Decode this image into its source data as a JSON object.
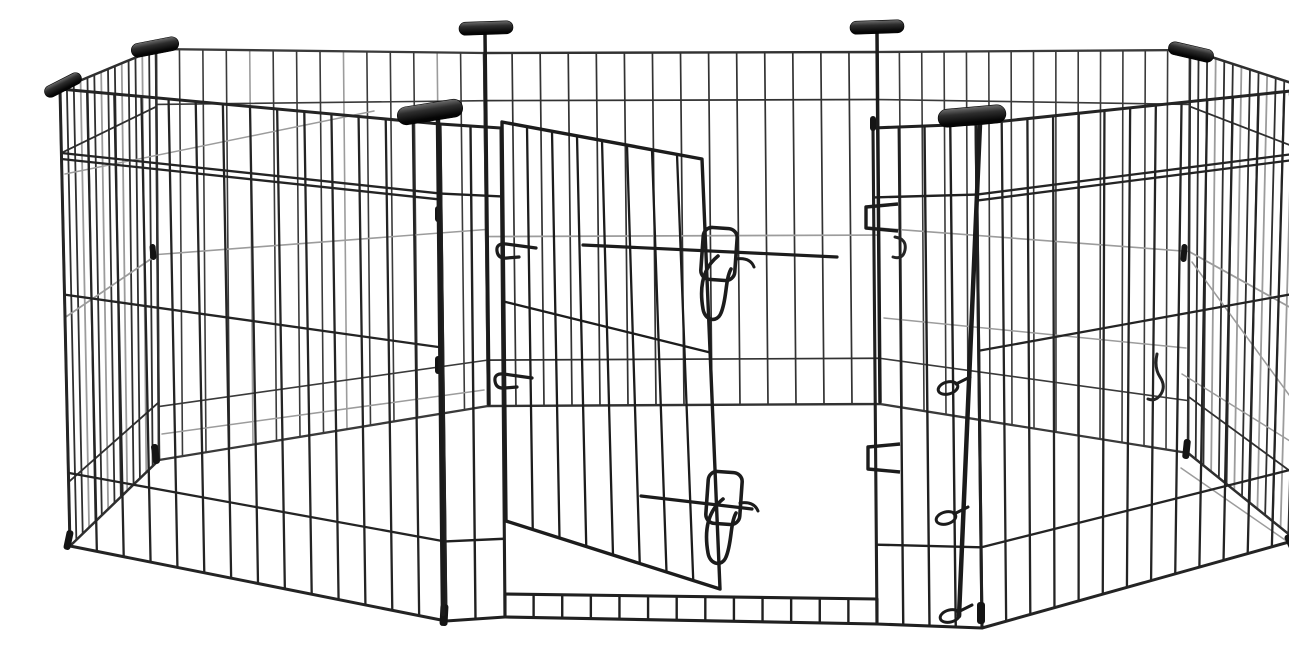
{
  "meta": {
    "type": "product-photo",
    "subject": "Black metal wire 8-panel foldable pet exercise playpen arranged as an octagon, with a walk-through gate standing ajar, two sliding wire latch clips, latch keeper brackets, black plastic corner caps, wire hinge pins and T-shaped carrying handles, photographed on a seamless white background",
    "background_color": "#ffffff",
    "wire_color_dark": "#242424",
    "wire_color_mid": "#383838",
    "wire_color_light": "#9c9c9c",
    "plastic_color": "#141414"
  },
  "pen": {
    "panels": [
      {
        "layer": "back",
        "name": "back-left",
        "tl": [
          116,
          33
        ],
        "tr": [
          444,
          37
        ],
        "br": [
          448,
          390
        ],
        "bl": [
          119,
          444
        ],
        "wires": 13,
        "stroke": "#3a3a3a",
        "width": 1.6,
        "light_every": 4,
        "rails": [
          {
            "t": 0.135
          },
          {
            "t": 0.5,
            "light": true
          },
          {
            "t": 0.87
          }
        ]
      },
      {
        "layer": "back",
        "name": "back-center",
        "tl": [
          444,
          37
        ],
        "tr": [
          837,
          36
        ],
        "br": [
          840,
          388
        ],
        "bl": [
          448,
          390
        ],
        "wires": 13,
        "stroke": "#323232",
        "width": 1.7,
        "rails": [
          {
            "t": 0.135
          },
          {
            "t": 0.52,
            "light": true
          },
          {
            "t": 0.87
          }
        ]
      },
      {
        "layer": "back",
        "name": "back-right",
        "tl": [
          837,
          36
        ],
        "tr": [
          1150,
          34
        ],
        "br": [
          1148,
          437
        ],
        "bl": [
          840,
          388
        ],
        "wires": 13,
        "stroke": "#3a3a3a",
        "width": 1.6,
        "rails": [
          {
            "t": 0.135
          },
          {
            "t": 0.5,
            "light": true
          },
          {
            "t": 0.87
          }
        ]
      },
      {
        "layer": "back",
        "name": "left-side",
        "tl": [
          20,
          73
        ],
        "tr": [
          116,
          33
        ],
        "br": [
          119,
          444
        ],
        "bl": [
          30,
          530
        ],
        "wires": 13,
        "stroke": "#2f2f2f",
        "width": 1.8,
        "light_every": 3,
        "rails": [
          {
            "t": 0.14
          },
          {
            "t": 0.5,
            "light": true
          },
          {
            "t": 0.86
          }
        ]
      },
      {
        "layer": "back",
        "name": "right-side",
        "tl": [
          1150,
          34
        ],
        "tr": [
          1270,
          73
        ],
        "br": [
          1256,
          524
        ],
        "bl": [
          1148,
          437
        ],
        "wires": 13,
        "stroke": "#2f2f2f",
        "width": 1.8,
        "light_every": 3,
        "rails": [
          {
            "t": 0.14
          },
          {
            "t": 0.5,
            "light": true
          },
          {
            "t": 0.86
          }
        ]
      },
      {
        "layer": "front",
        "name": "front-left",
        "tl": [
          20,
          73
        ],
        "tr": [
          400,
          108
        ],
        "br": [
          406,
          605
        ],
        "bl": [
          30,
          530
        ],
        "wires": 13,
        "stroke": "#242424",
        "width": 2.3,
        "rails": [
          {
            "t": 0.14,
            "d": true
          },
          {
            "t": 0.45
          },
          {
            "t": 0.84
          }
        ]
      },
      {
        "layer": "front",
        "name": "front-right",
        "tl": [
          936,
          108
        ],
        "tr": [
          1270,
          73
        ],
        "br": [
          1256,
          524
        ],
        "bl": [
          942,
          612
        ],
        "wires": 12,
        "stroke": "#242424",
        "width": 2.3,
        "rails": [
          {
            "t": 0.14,
            "d": true
          },
          {
            "t": 0.45
          },
          {
            "t": 0.84
          }
        ]
      },
      {
        "layer": "front",
        "name": "gate-left-section",
        "tl": [
          400,
          108
        ],
        "tr": [
          461,
          112
        ],
        "br": [
          465,
          601
        ],
        "bl": [
          406,
          605
        ],
        "wires": 1,
        "stroke": "#202020",
        "width": 2.4,
        "rails": [
          {
            "t": 0.14
          },
          {
            "t": 0.84
          }
        ]
      },
      {
        "layer": "front",
        "name": "gate-right-section",
        "tl": [
          833,
          112
        ],
        "tr": [
          936,
          108
        ],
        "br": [
          942,
          612
        ],
        "bl": [
          837,
          608
        ],
        "wires": 3,
        "stroke": "#202020",
        "width": 2.4,
        "rails": [
          {
            "t": 0.14
          },
          {
            "t": 0.84
          }
        ]
      },
      {
        "layer": "front",
        "name": "gate-threshold",
        "tl": [
          465,
          578
        ],
        "tr": [
          837,
          583
        ],
        "br": [
          837,
          608
        ],
        "bl": [
          465,
          601
        ],
        "wires": 12,
        "stroke": "#202020",
        "width": 2.4,
        "rails": []
      }
    ],
    "light_wires": [
      [
        25,
        158,
        334,
        95
      ],
      [
        122,
        418,
        444,
        374
      ],
      [
        1152,
        246,
        1263,
        398
      ],
      [
        1142,
        358,
        1258,
        430
      ],
      [
        1141,
        452,
        1248,
        526
      ],
      [
        844,
        302,
        1146,
        332
      ]
    ],
    "door": {
      "frame": {
        "tl": [
          462,
          106
        ],
        "tr": [
          662,
          143
        ],
        "br": [
          680,
          573
        ],
        "bl": [
          466,
          505
        ]
      },
      "wires": 7,
      "stroke": "#1c1c1c",
      "width": 2.6,
      "rails": [
        0.45
      ],
      "bars": [
        [
          543,
          229,
          797,
          241
        ],
        [
          601,
          480,
          712,
          493
        ]
      ],
      "latches": [
        {
          "loop": {
            "x": 662,
            "y": 212,
            "w": 34,
            "h": 52,
            "rx": 9,
            "rot": 4
          },
          "hook": "M678,240 C663,252 659,270 663,293 C665,305 677,307 681,297 C687,283 685,264 691,253",
          "snag": "M696,243 q14,-2 18,8"
        },
        {
          "loop": {
            "x": 667,
            "y": 456,
            "w": 34,
            "h": 52,
            "rx": 9,
            "rot": 4
          },
          "hook": "M683,483 C668,495 664,514 668,537 C670,549 682,551 686,541 C692,527 690,508 696,497",
          "snag": "M700,487 q14,-2 18,8"
        }
      ],
      "hinges": [
        "M496,232 L466,228 q-10,-1 -9,7 q1,8 10,7 l12,-1",
        "M492,362 L464,358 q-10,-1 -9,7 q1,8 10,7 l12,-1"
      ]
    },
    "keepers": [
      "M858,188 L826,191 L826,212 L858,215",
      "M860,428 L828,431 L828,453 L860,456"
    ],
    "hooks": [
      "M855,221 q12,2 10,13 q-2,10 -12,7",
      "M1117,338 q-3,14 3,23 q6,9 1,17 q-5,8 -13,5"
    ],
    "pins": {
      "loops": [
        {
          "cx": 908,
          "cy": 372,
          "rx": 10,
          "ry": 6,
          "rot": -15
        },
        {
          "cx": 906,
          "cy": 502,
          "rx": 10,
          "ry": 6,
          "rot": -15
        },
        {
          "cx": 910,
          "cy": 600,
          "rx": 10,
          "ry": 6,
          "rot": -15
        }
      ],
      "tails": [
        [
          916,
          368,
          930,
          361
        ],
        [
          914,
          498,
          928,
          491
        ],
        [
          918,
          596,
          932,
          589
        ]
      ]
    },
    "grips": [
      {
        "cx": 390,
        "cy": 96,
        "len": 66,
        "h": 18,
        "rot": -9,
        "stem": [
          398,
          104,
          403,
          598,
          4.5
        ]
      },
      {
        "cx": 932,
        "cy": 100,
        "len": 68,
        "h": 18,
        "rot": -5,
        "stem": [
          940,
          108,
          919,
          600,
          4.5
        ]
      },
      {
        "cx": 446,
        "cy": 12,
        "len": 54,
        "h": 13,
        "rot": -2,
        "stem": [
          445,
          18,
          449,
          388,
          3.5
        ]
      },
      {
        "cx": 837,
        "cy": 11,
        "len": 54,
        "h": 13,
        "rot": -2,
        "stem": [
          837,
          17,
          840,
          386,
          3.5
        ]
      }
    ],
    "caps": [
      {
        "cx": 115,
        "cy": 31,
        "len": 48,
        "h": 14,
        "rot": -11
      },
      {
        "cx": 23,
        "cy": 69,
        "len": 40,
        "h": 12,
        "rot": -27
      },
      {
        "cx": 1151,
        "cy": 36,
        "len": 46,
        "h": 13,
        "rot": 13
      },
      {
        "cx": 1277,
        "cy": 65,
        "len": 26,
        "h": 10,
        "rot": 28
      }
    ],
    "ring": {
      "cx": 1261,
      "cy": 78,
      "r": 10
    },
    "sleeves": [
      {
        "x": 395,
        "y": 190,
        "w": 6,
        "h": 16,
        "rot": 0
      },
      {
        "x": 395,
        "y": 340,
        "w": 7,
        "h": 18,
        "rot": 0
      },
      {
        "x": 110,
        "y": 228,
        "w": 6,
        "h": 16,
        "rot": -5
      },
      {
        "x": 25,
        "y": 514,
        "w": 7,
        "h": 20,
        "rot": 12
      },
      {
        "x": 112,
        "y": 428,
        "w": 7,
        "h": 20,
        "rot": -8
      },
      {
        "x": 400,
        "y": 588,
        "w": 8,
        "h": 22,
        "rot": 3
      },
      {
        "x": 937,
        "y": 586,
        "w": 8,
        "h": 22,
        "rot": 0
      },
      {
        "x": 1141,
        "y": 228,
        "w": 6,
        "h": 18,
        "rot": 4
      },
      {
        "x": 1143,
        "y": 423,
        "w": 7,
        "h": 20,
        "rot": 6
      },
      {
        "x": 1247,
        "y": 518,
        "w": 7,
        "h": 18,
        "rot": -25
      },
      {
        "x": 830,
        "y": 100,
        "w": 6,
        "h": 15,
        "rot": 0
      }
    ]
  }
}
